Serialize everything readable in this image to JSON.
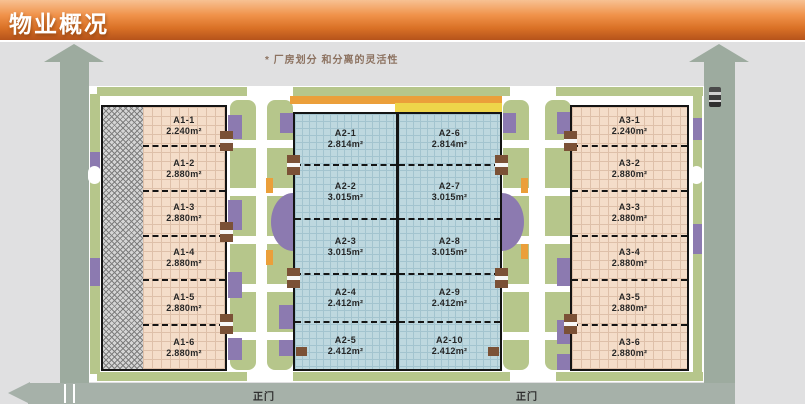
{
  "header": {
    "title": "物业概况"
  },
  "annotation": "* 厂房划分 和分离的灵活性",
  "site": {
    "gate_label_left": "正门",
    "gate_label_right": "正门"
  },
  "buildings": {
    "a1": {
      "name": "A1",
      "units": [
        {
          "id": "A1-1",
          "area": "2.240m²"
        },
        {
          "id": "A1-2",
          "area": "2.880m²"
        },
        {
          "id": "A1-3",
          "area": "2.880m²"
        },
        {
          "id": "A1-4",
          "area": "2.880m²"
        },
        {
          "id": "A1-5",
          "area": "2.880m²"
        },
        {
          "id": "A1-6",
          "area": "2.880m²"
        }
      ]
    },
    "a2_left": {
      "name": "A2 west bay",
      "units": [
        {
          "id": "A2-1",
          "area": "2.814m²"
        },
        {
          "id": "A2-2",
          "area": "3.015m²"
        },
        {
          "id": "A2-3",
          "area": "3.015m²"
        },
        {
          "id": "A2-4",
          "area": "2.412m²"
        },
        {
          "id": "A2-5",
          "area": "2.412m²"
        }
      ]
    },
    "a2_right": {
      "name": "A2 east bay",
      "units": [
        {
          "id": "A2-6",
          "area": "2.814m²"
        },
        {
          "id": "A2-7",
          "area": "3.015m²"
        },
        {
          "id": "A2-8",
          "area": "3.015m²"
        },
        {
          "id": "A2-9",
          "area": "2.412m²"
        },
        {
          "id": "A2-10",
          "area": "2.412m²"
        }
      ]
    },
    "a3": {
      "name": "A3",
      "units": [
        {
          "id": "A3-1",
          "area": "2.240m²"
        },
        {
          "id": "A3-2",
          "area": "2.880m²"
        },
        {
          "id": "A3-3",
          "area": "2.880m²"
        },
        {
          "id": "A3-4",
          "area": "2.880m²"
        },
        {
          "id": "A3-5",
          "area": "2.880m²"
        },
        {
          "id": "A3-6",
          "area": "2.880m²"
        }
      ]
    }
  },
  "colors": {
    "header_orange": "#d96f22",
    "landscape_green": "#b6c68b",
    "planter_purple": "#8c7ab0",
    "accent_orange": "#eb9f3a",
    "accent_yellow": "#eed54a",
    "road_gray": "#a6b1a9",
    "a1_a3_fill": "#f4ddc9",
    "a2_fill": "#bed8df",
    "dock_brown": "#7b5136"
  }
}
